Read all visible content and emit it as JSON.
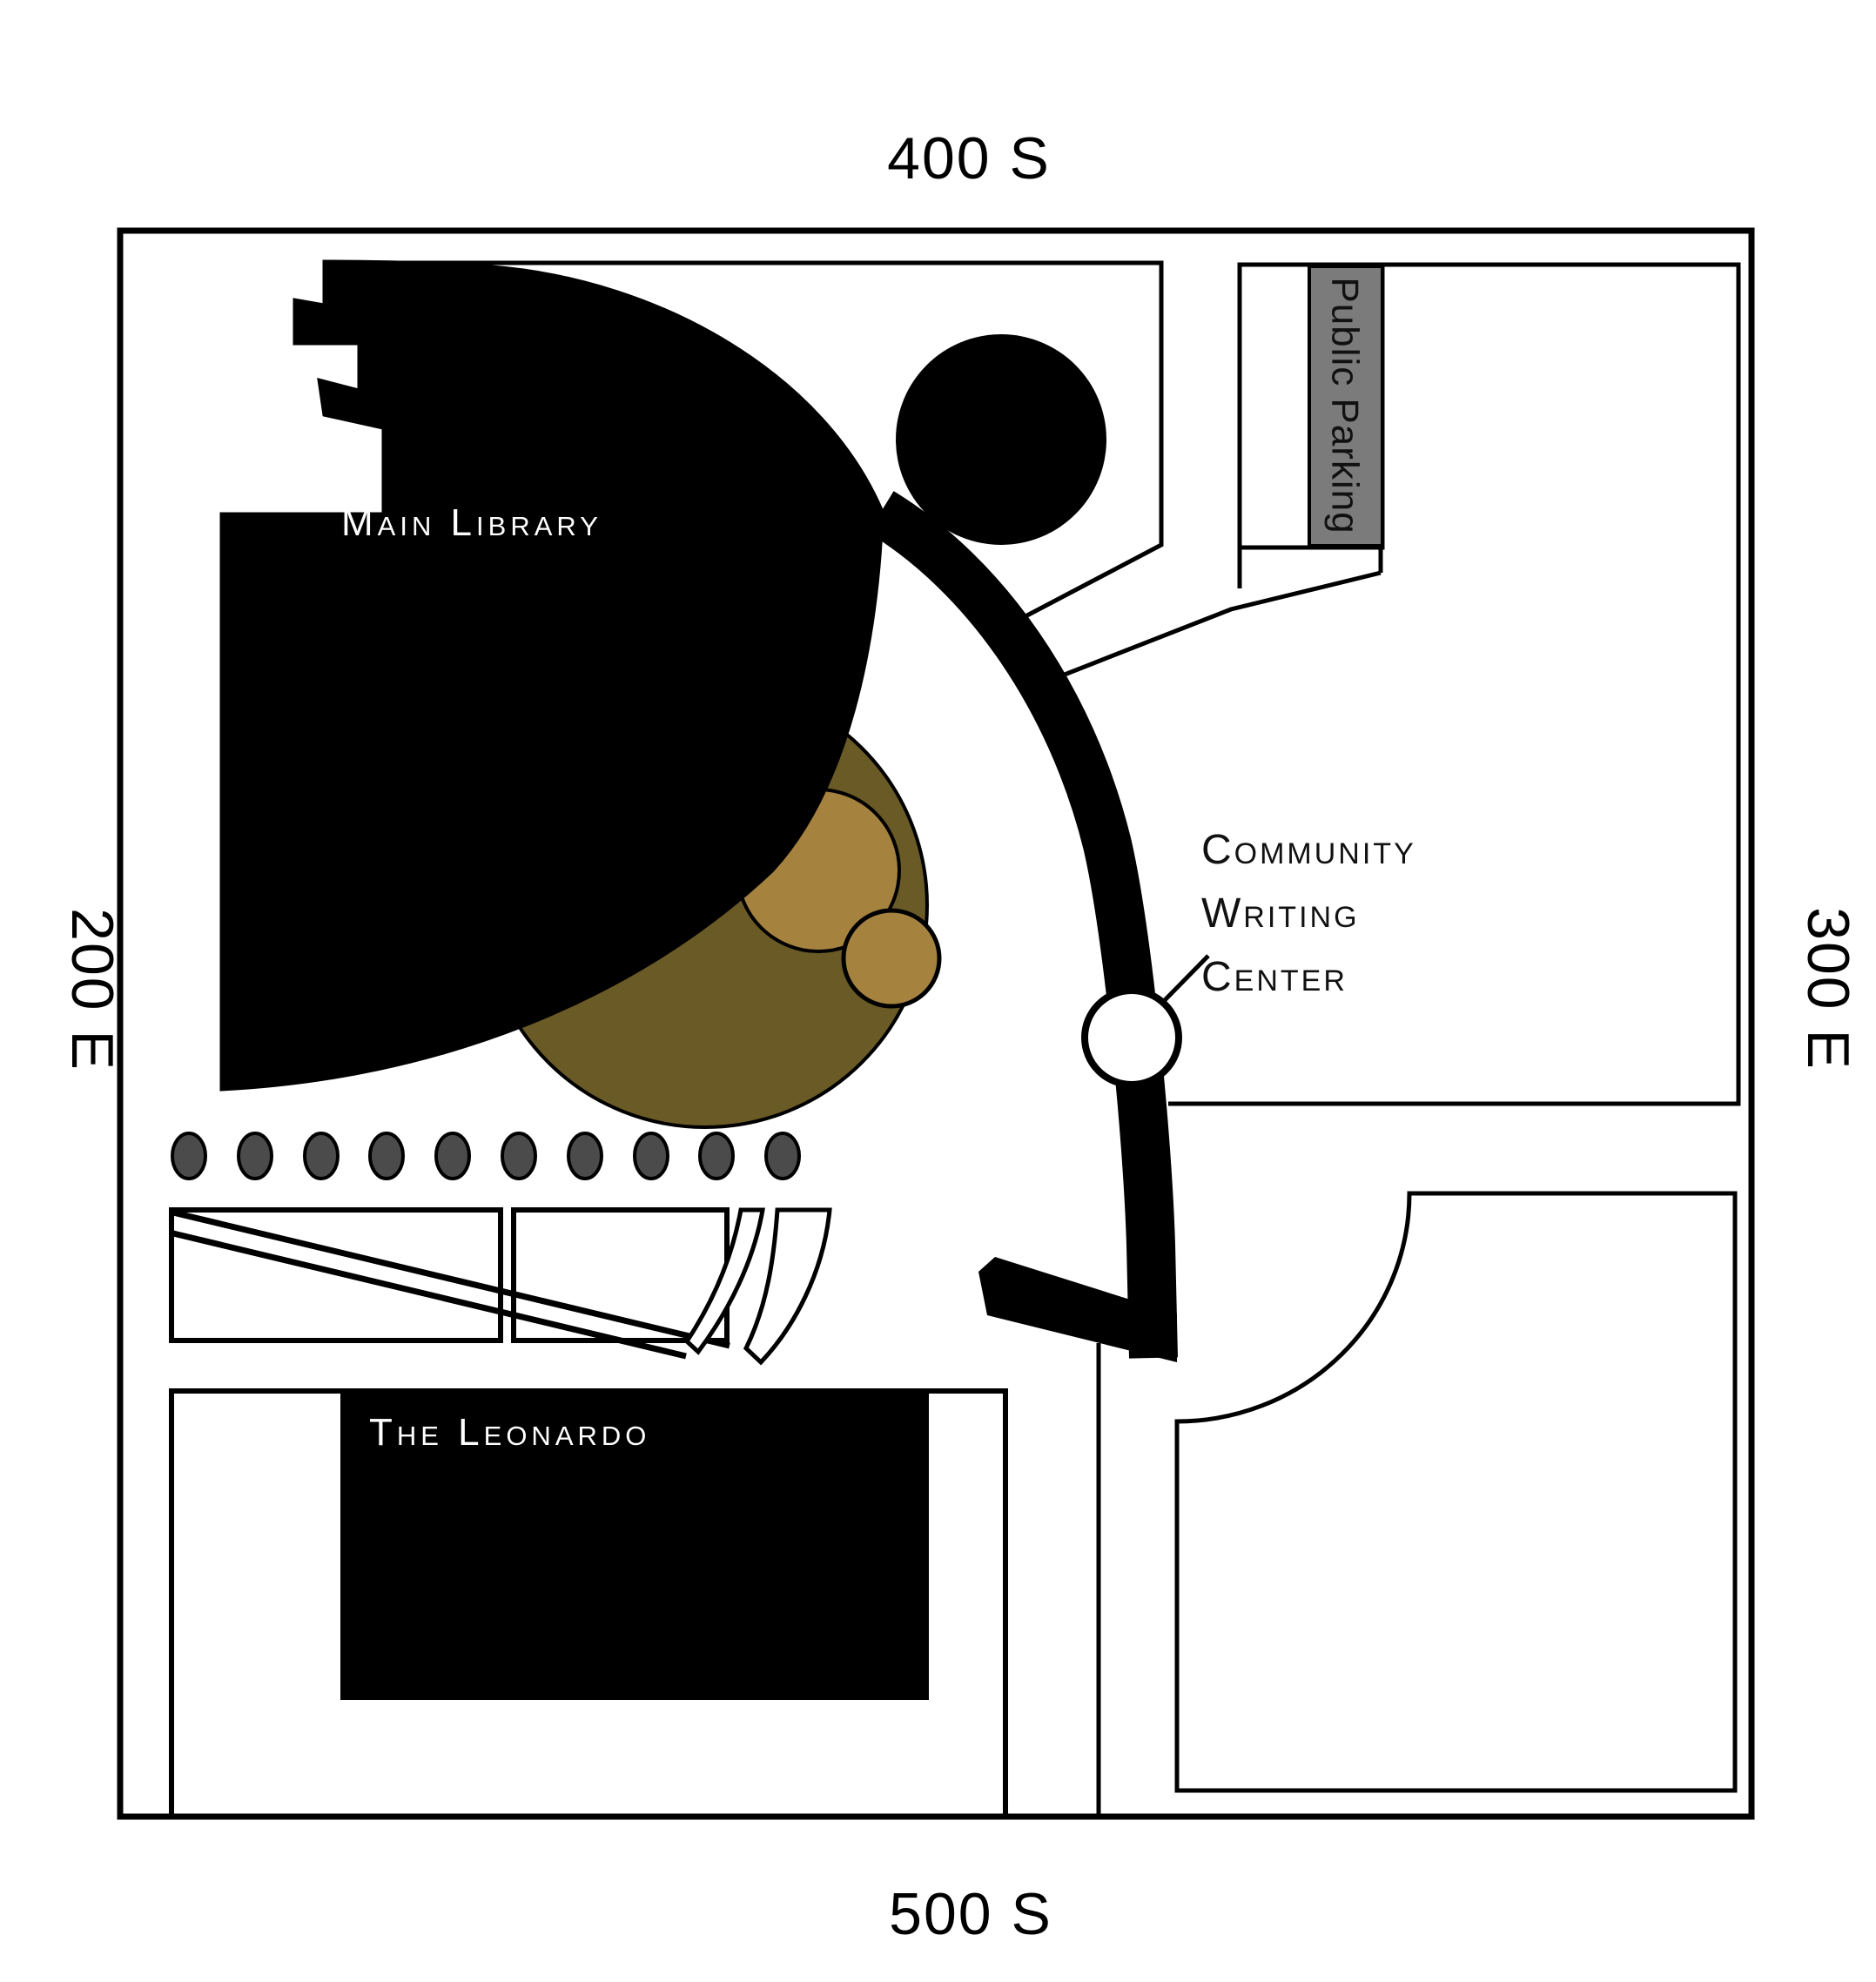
{
  "streets": {
    "top": "400 S",
    "bottom": "500 S",
    "left": "200 E",
    "right": "300 E"
  },
  "places": {
    "library": "Main Library",
    "leonardo": "The Leonardo",
    "public_parking": "Public Parking",
    "community_writing_center": {
      "line1": "Community",
      "line2": "Writing",
      "line3": "Center"
    }
  },
  "colors": {
    "ink": "#000000",
    "background": "#ffffff",
    "parking_strip": "#7b7b7b",
    "plaza_large_circle": "#6a5a26",
    "plaza_small_circles": "#a6823f",
    "dots": "#4b4b4b"
  }
}
